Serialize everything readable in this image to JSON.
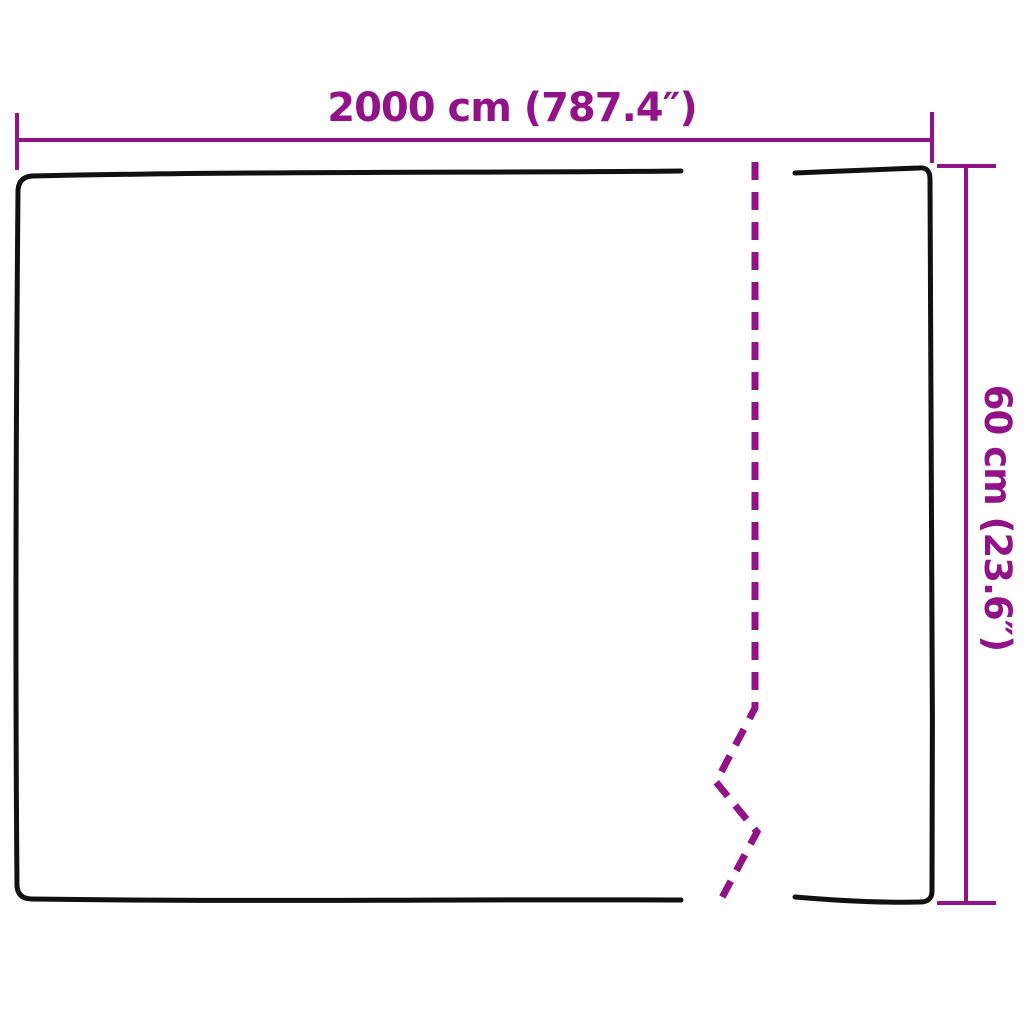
{
  "colors": {
    "dimension_accent": "#921387",
    "outline": "#111111",
    "background": "#ffffff"
  },
  "diagram": {
    "width_dimension": {
      "label": "2000 cm (787.4″)",
      "value_cm": 2000,
      "value_inches": 787.4
    },
    "height_dimension": {
      "label": "60 cm (23.6″)",
      "value_cm": 60,
      "value_inches": 23.6
    }
  }
}
